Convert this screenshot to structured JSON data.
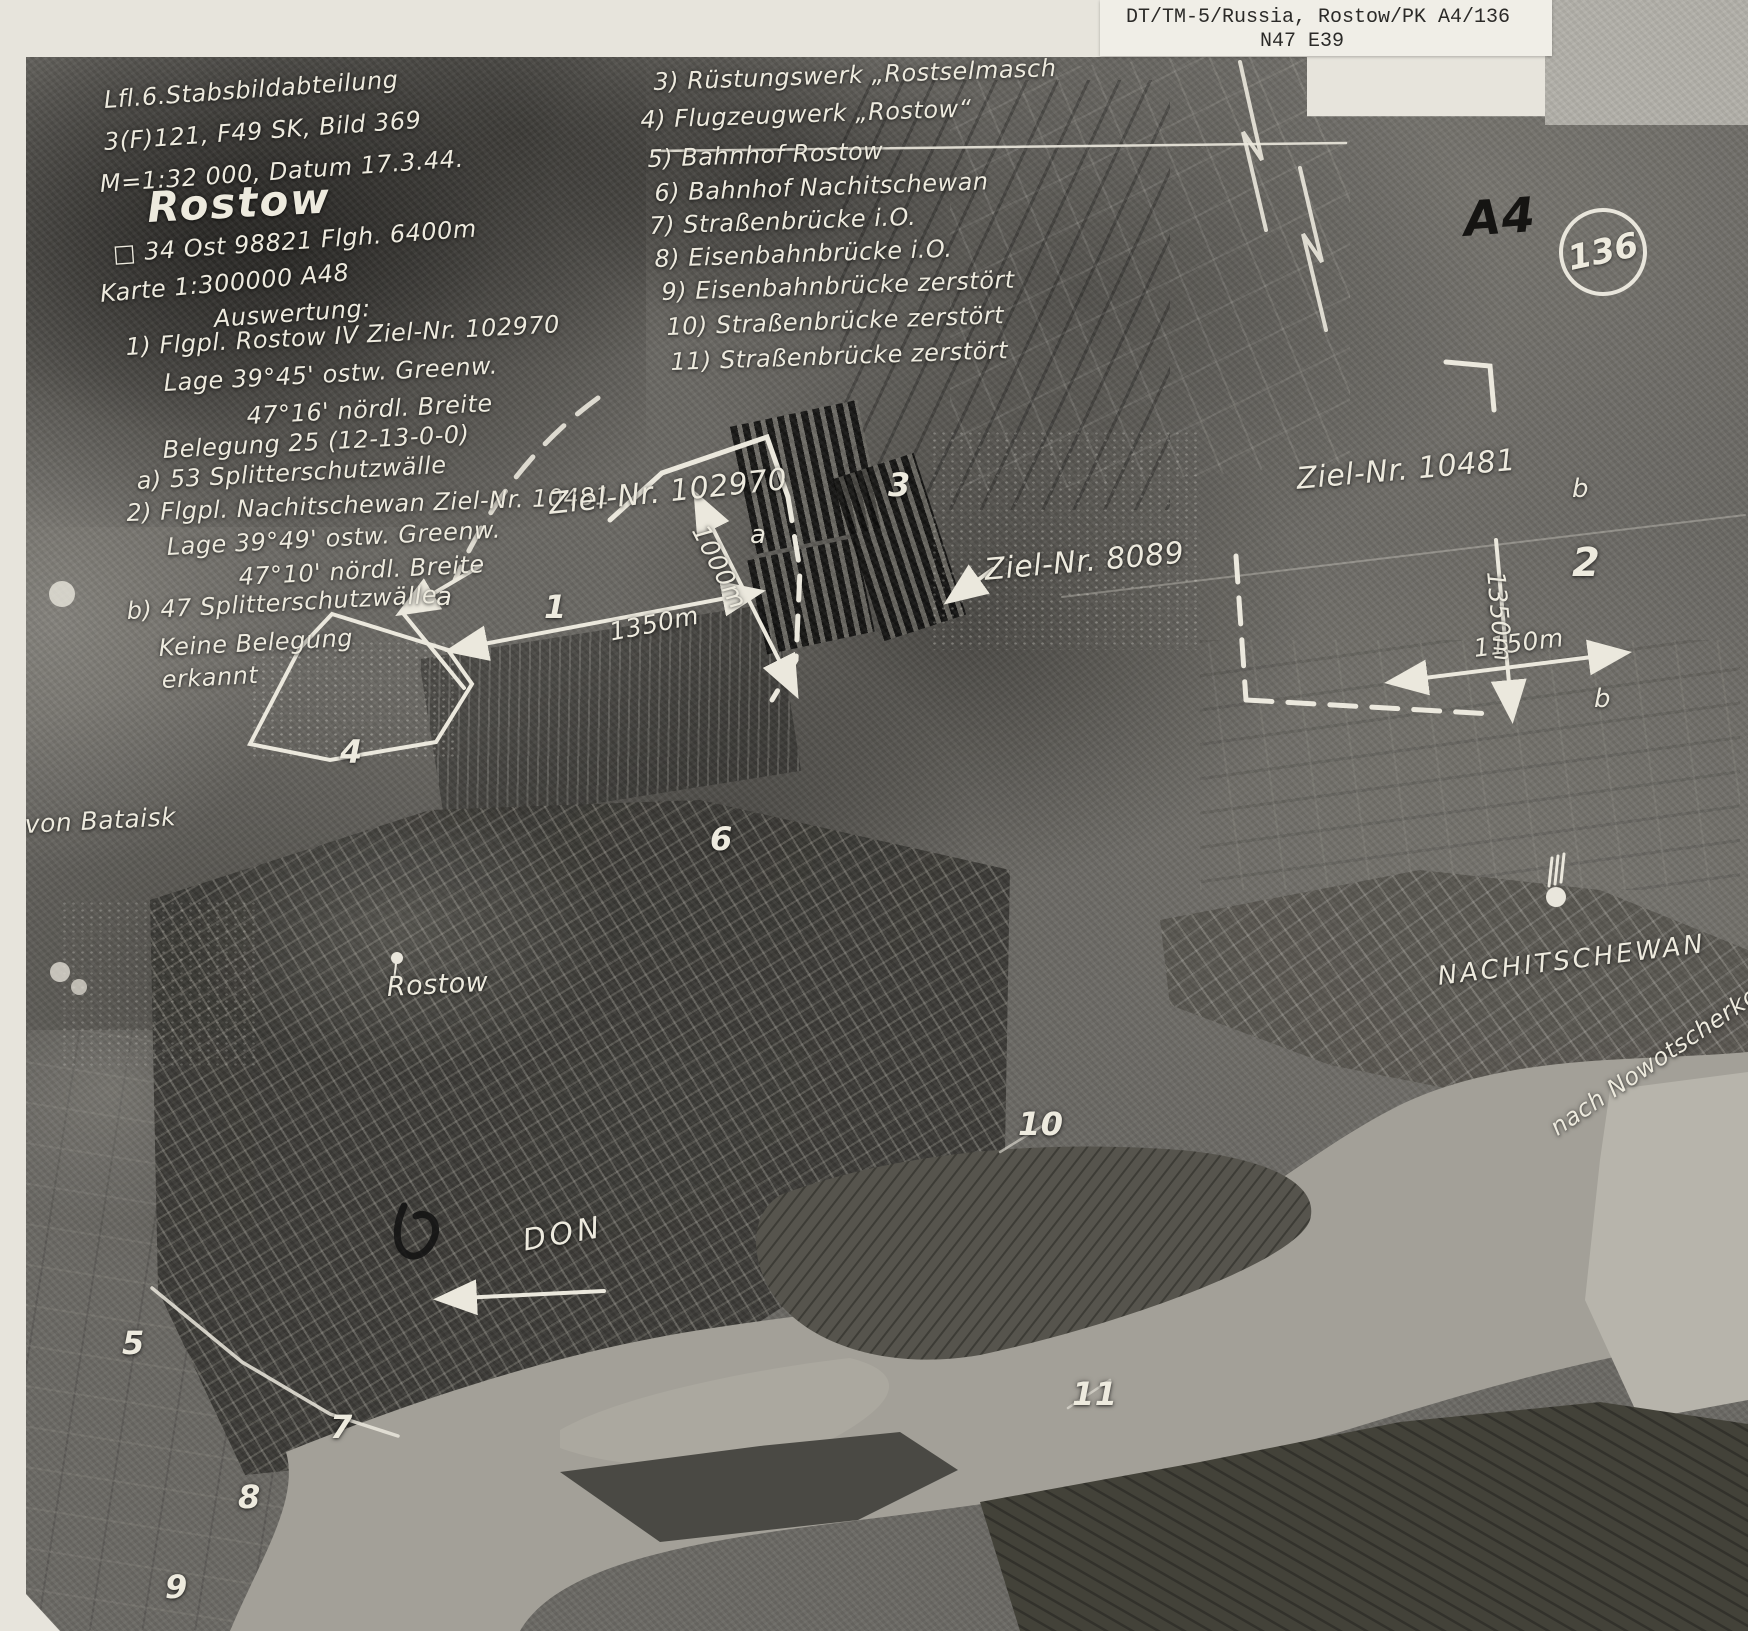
{
  "header": {
    "line1": "DT/TM-5/Russia, Rostow/PK A4/136",
    "line2": "N47  E39"
  },
  "info": {
    "line1": "Lfl.6.Stabsbildabteilung",
    "line2": "3(F)121, F49 SK, Bild 369",
    "line3": "M=1:32 000, Datum 17.3.44.",
    "title": "Rostow",
    "line4": "□ 34 Ost 98821  Flgh. 6400m",
    "line5": "Karte 1:300000  A48"
  },
  "auswertung": {
    "heading": "Auswertung:",
    "lines": [
      "1) Flgpl. Rostow IV  Ziel-Nr. 102970",
      "Lage 39°45' ostw. Greenw.",
      "47°16' nördl. Breite",
      "Belegung 25 (12-13-0-0)",
      "a) 53 Splitterschutzwälle",
      "2) Flgpl. Nachitschewan Ziel-Nr. 10481",
      "Lage 39°49' ostw. Greenw.",
      "47°10' nördl. Breite",
      "b) 47 Splitterschutzwälle",
      "Keine Belegung",
      "erkannt"
    ]
  },
  "legend": {
    "items": [
      "3) Rüstungswerk „Rostselmasch",
      "4) Flugzeugwerk „Rostow“",
      "5) Bahnhof Rostow",
      "6) Bahnhof Nachitschewan",
      "7) Straßenbrücke i.O.",
      "8) Eisenbahnbrücke i.O.",
      "9) Eisenbahnbrücke zerstört",
      "10) Straßenbrücke zerstört",
      "11) Straßenbrücke zerstört"
    ]
  },
  "labels": {
    "ziel102970": "Ziel-Nr. 102970",
    "ziel8089": "Ziel-Nr. 8089",
    "ziel10481": "Ziel-Nr. 10481",
    "nachitschewan": "NACHITSCHEWAN",
    "nowotscherkassk": "nach Nowotscherko",
    "rostow_city": "Rostow",
    "don": "DON",
    "bataisk": "von Bataisk",
    "a4": "A4",
    "frame_number": "136"
  },
  "scales": {
    "s1350a": "1350m",
    "s1000": "1000m",
    "s1150": "1150m",
    "s1350b": "1350m"
  },
  "markers": {
    "n1": "1",
    "n2": "2",
    "n3": "3",
    "n4": "4",
    "n5": "5",
    "n6": "6",
    "n7": "7",
    "n8": "8",
    "n9": "9",
    "n10": "10",
    "n11": "11",
    "a1": "a",
    "a2": "a",
    "b1": "b",
    "b2": "b"
  },
  "colors": {
    "paper": "#e7e4dc",
    "photo_base": "#6b6964",
    "annotation_ink": "#edeade",
    "pencil_black": "#151412",
    "river": "#a3a098"
  }
}
